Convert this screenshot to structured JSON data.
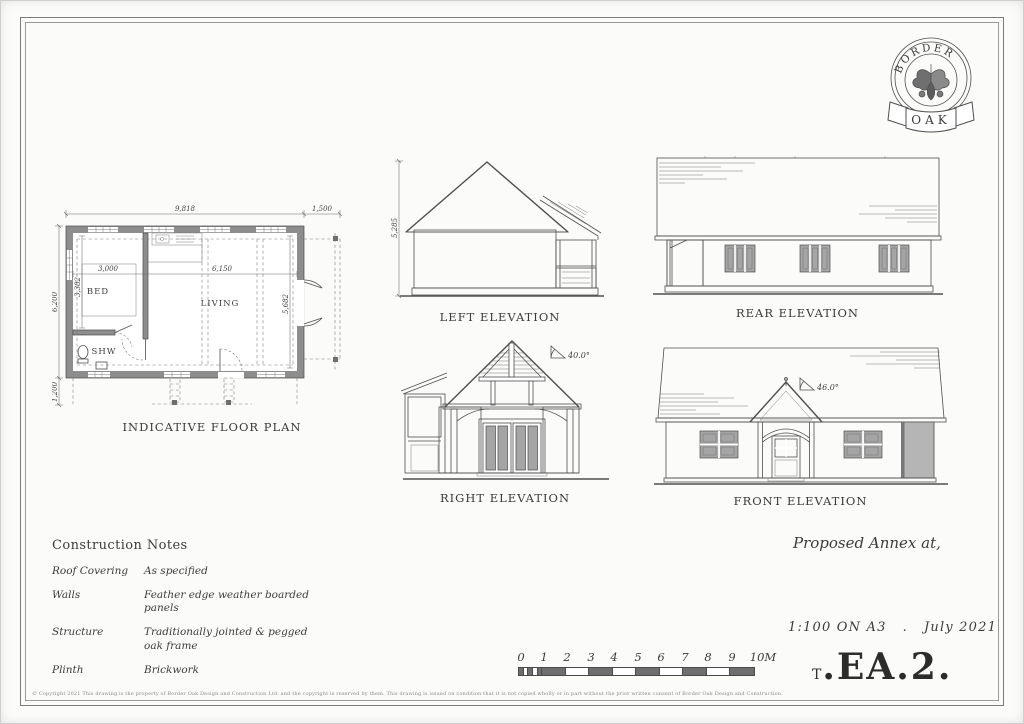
{
  "sheet": {
    "copyright": "© Copyright 2021  This drawing is the property of Border Oak Design and Construction Ltd. and the copyright is reserved by them. This drawing is issued on condition that it is not copied wholly or in part without the prior written consent of Border Oak Design and Construction."
  },
  "logo": {
    "arc_text": "BORDER",
    "banner_text": "OAK"
  },
  "floor_plan": {
    "caption": "INDICATIVE FLOOR PLAN",
    "rooms": {
      "bed": "BED",
      "living": "LIVING",
      "shower": "SHW"
    },
    "dims": {
      "overall_width": "9,818",
      "porch_projection": "1,500",
      "overall_depth": "6,200",
      "veranda_projection": "1,200",
      "bed_width": "3,000",
      "living_width": "6,150",
      "bed_depth": "3,382",
      "living_depth": "5,682"
    }
  },
  "elevations": {
    "left": {
      "caption": "LEFT ELEVATION",
      "ridge_height": "5,285"
    },
    "rear": {
      "caption": "REAR ELEVATION"
    },
    "right": {
      "caption": "RIGHT ELEVATION",
      "roof_pitch": "40.0°"
    },
    "front": {
      "caption": "FRONT ELEVATION",
      "roof_pitch": "46.0°"
    }
  },
  "construction_notes": {
    "title": "Construction Notes",
    "rows": [
      {
        "label": "Roof Covering",
        "value": "As specified"
      },
      {
        "label": "Walls",
        "value": "Feather edge weather boarded panels"
      },
      {
        "label": "Structure",
        "value": "Traditionally jointed & pegged oak frame"
      },
      {
        "label": "Plinth",
        "value": "Brickwork"
      }
    ]
  },
  "title_block": {
    "project_title": "Proposed Annex at,",
    "scale": "1:100 ON A3",
    "separator": ".",
    "date": "July 2021",
    "drawing_ref_prefix": "T",
    "drawing_ref": ".EA.2."
  },
  "scale_bar": {
    "ticks": [
      "0",
      "1",
      "2",
      "3",
      "4",
      "5",
      "6",
      "7",
      "8",
      "9",
      "10M"
    ]
  },
  "colors": {
    "line": "#4f4f4f",
    "wall_fill": "#8d8d8d",
    "paper": "#ffffff"
  }
}
